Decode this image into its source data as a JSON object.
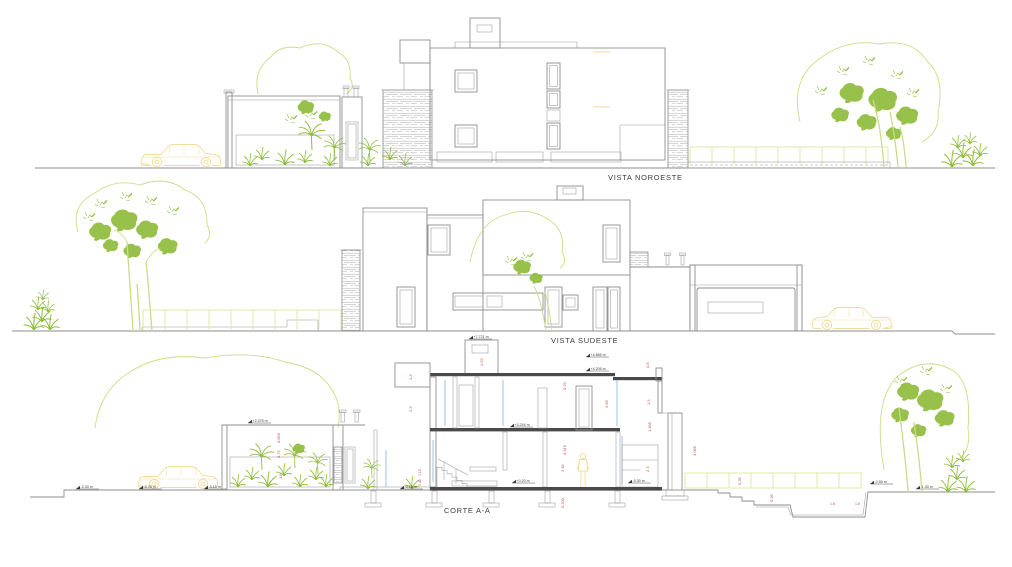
{
  "drawings": {
    "vista_noroeste": {
      "label": "VISTA NOROESTE"
    },
    "vista_sudeste": {
      "label": "VISTA SUDESTE"
    },
    "corte_aa": {
      "label": "CORTE A-A",
      "levels": {
        "chimney_top": "+7.721 m",
        "parapet": "+4.865 m",
        "roof": "+4.205 m",
        "upper_floor": "+3.244 m",
        "courtyard_wall": "+2.375 m",
        "ground_floor": "+0.20 m",
        "walkway": "-0.18 m",
        "terrain_left_1": "-0.30 m",
        "terrain_left_2": "-0.35 m",
        "terrain_left_3": "-0.15 m",
        "garage_floor": "-0.30 m",
        "basin_top": "-0.50 m",
        "terrain_right": "-1.00 m"
      },
      "dimensions": {
        "chimney": "1.52",
        "parapet_left": "1.3",
        "wall_left": "2.3",
        "beam": "0.29",
        "upper_room": "2.65",
        "slab": "0.315",
        "lower_room": "2.45",
        "found_depth": "0.200",
        "court_upper": "0.855",
        "court_mid": "0.72",
        "court_low": "1.8",
        "parapet_right": "0.8",
        "right_upper": "1.5",
        "right_mid": "1.465",
        "right_total": "3.065",
        "storage": "2.3",
        "fence": "0.35",
        "steps": "0.95",
        "basin_a": "1.8",
        "basin_b": "1.6",
        "foot_a": "0.15",
        "foot_b": "0.45"
      }
    }
  },
  "colors": {
    "line": "#8e8e8e",
    "line_dark": "#4a4a4a",
    "vegetation": "#8fbc3c",
    "vegetation_light": "#c9dd86",
    "fence": "#dfe9a8",
    "accent_yellow": "#f2dc9c",
    "dimension_red": "#c0504d",
    "glazing_blue": "#9cc3e5"
  }
}
